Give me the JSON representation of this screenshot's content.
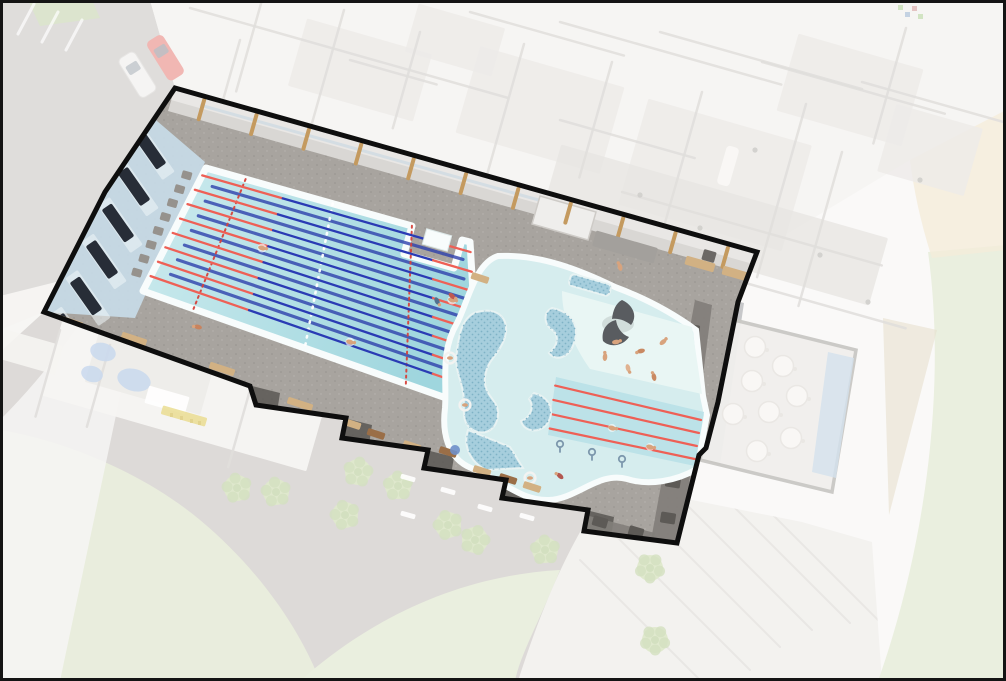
{
  "meta": {
    "description": "Aerial 3D architectural rendering of a leisure-centre site plan; the swimming pool hall is shown in full colour and traced with a thick black outline while the surrounding building, cafe terrace, car park and landscaping are faded.",
    "canvas": {
      "width": 1006,
      "height": 681
    }
  },
  "palette": {
    "bg": "#f7f6f4",
    "frame": "#141414",
    "fadeVeil": "#ffffff",
    "road": "#cbc8c5",
    "path": "#f1f0ed",
    "plaza": "#c9c4c0",
    "lawn": "#dbe3c8",
    "lawn2": "#dde5cb",
    "tree1": "#ccdbae",
    "tree2": "#b9ce9a",
    "terrace": "#eceae6",
    "terraceLine": "#dbd8d4",
    "tanPath": "#d8cdb0",
    "beige": "#eee1c4",
    "bldgWall": "#f1efec",
    "bldgLine": "#cecbc7",
    "roomFloor": "#e2dfdb",
    "corridor": "#d8d5d0",
    "cafeFloor": "#e8e6e2",
    "cafeWall": "#a9a6a1",
    "tableFill": "#f6f3ef",
    "tableStroke": "#ddd9d3",
    "blueWall": "#b9cfe4",
    "facadeDark": "#898c91",
    "facadeGlass": "#a9c0da",
    "carRed": "#e88b85",
    "carWhite": "#efeeec",
    "carGlass": "#8f98a3",
    "lockers": "#ddc84f",
    "waterFeature": "#a8c2e4",
    "greenHedge": "#c5d8a8",
    "deck": "#a8a49f",
    "deckDark": "#827e7a",
    "deckBlock": "#5d5a56",
    "stepShadow": "#55524f",
    "outline": "#0e0e0e",
    "poolEdge": "#f8fcfc",
    "waterA": "#cdebee",
    "waterB": "#9fd6de",
    "ropeRed": "#ee6056",
    "ropeBlue": "#2a3bb4",
    "floorLane": "#2e40ac",
    "dashRed": "#d6433c",
    "centerDot": "#ffffff",
    "leisureWater": "#d6edee",
    "splash": "#e9f6f4",
    "learner": "#bce2e8",
    "island": "#a6cedd",
    "islandDot": "#7fb2c6",
    "whale": "#595c60",
    "seatBand": "#c8dde9",
    "seatStripe": "#eef5f8",
    "benchNavy": "#272d37",
    "blockGray": "#96928d",
    "columnTan": "#c49a5f",
    "wallStrip": "#d9d7d4",
    "wallWhite": "#efeeec",
    "wallGray": "#a3a09c",
    "doorDark": "#6b6865",
    "benchTan": "#d2b183",
    "lounger": "#9a6e47",
    "parasolBlue": "#6f8fc9",
    "skin": "#d8a37d",
    "ringWhite": "#f3f3f1",
    "swimSplash": "#ffffff",
    "ladder": "#7d98ad"
  },
  "scene": {
    "highlight": {
      "label": "pool-hall",
      "lap_pool": {
        "lanes": 8,
        "floor_lines": 7,
        "rope_colors": {
          "end": "#ee6056",
          "middle": "#2a3bb4"
        },
        "dashed_marker_lines": 2,
        "starting_blocks": 8,
        "swimmers": 3
      },
      "teaching_pool": {
        "lane_ropes": 4,
        "ladders": 3,
        "swimmers": 2
      },
      "leisure_pool": {
        "features": [
          "lazy-river",
          "mosaic-islands",
          "whale-tail-sculpture",
          "splash-beach"
        ],
        "bathers": 6,
        "ring-floaters": 3
      },
      "spectator_benches": 6,
      "wall_columns": 11,
      "deck_loungers": 7,
      "deck_steps": 5
    },
    "context": {
      "cars": [
        {
          "color": "carRed"
        },
        {
          "color": "carWhite"
        }
      ],
      "cafe_tables": 8,
      "trees": 10,
      "white_loungers": 5,
      "terrace_lines": 6,
      "faded_people": 7,
      "lawns": 3
    }
  }
}
